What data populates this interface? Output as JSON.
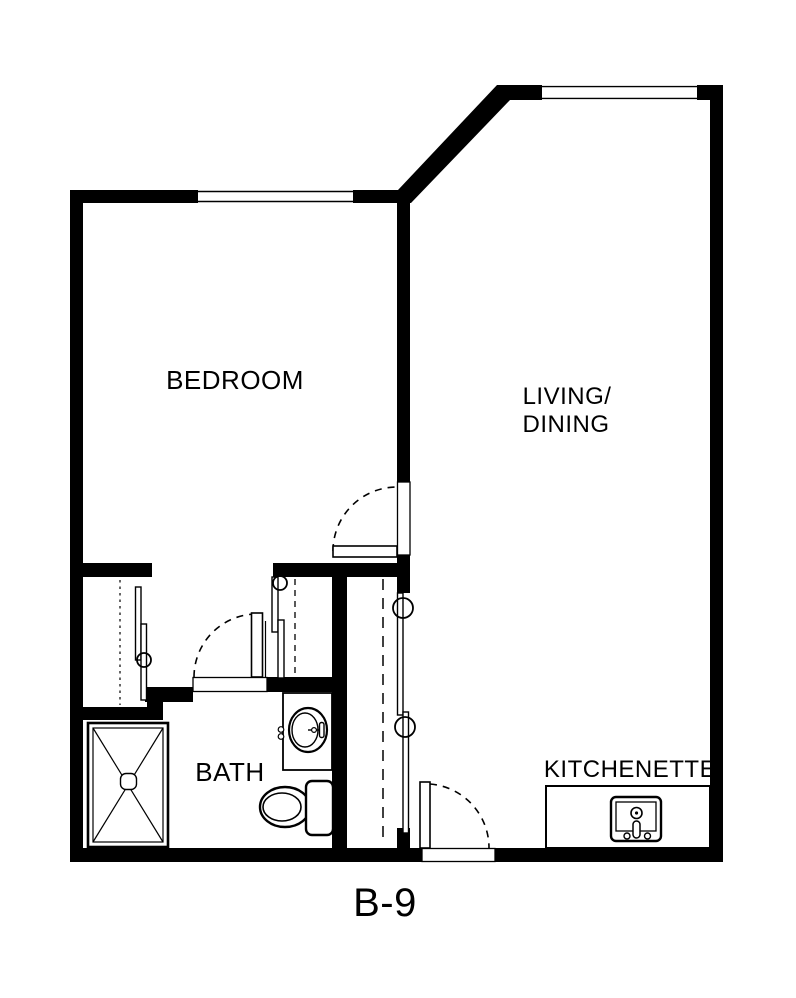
{
  "plan": {
    "unit_label": "B-9",
    "rooms": {
      "bedroom": "BEDROOM",
      "living_line1": "LIVING/",
      "living_line2": "DINING",
      "bath": "BATH",
      "kitchenette": "KITCHENETTE"
    },
    "fixtures": [
      "shower-fixture",
      "toilet-fixture",
      "bath-sink-fixture",
      "kitchenette-sink-fixture",
      "kitchenette-counter"
    ],
    "doors": [
      "bedroom-door",
      "bath-door",
      "entry-door"
    ],
    "closets": [
      "bedroom-closet-left",
      "bedroom-closet-right",
      "entry-closet"
    ],
    "windows": [
      "bedroom-window",
      "living-window"
    ],
    "colors": {
      "wall": "#000000",
      "background": "#ffffff",
      "line": "#000000"
    }
  }
}
